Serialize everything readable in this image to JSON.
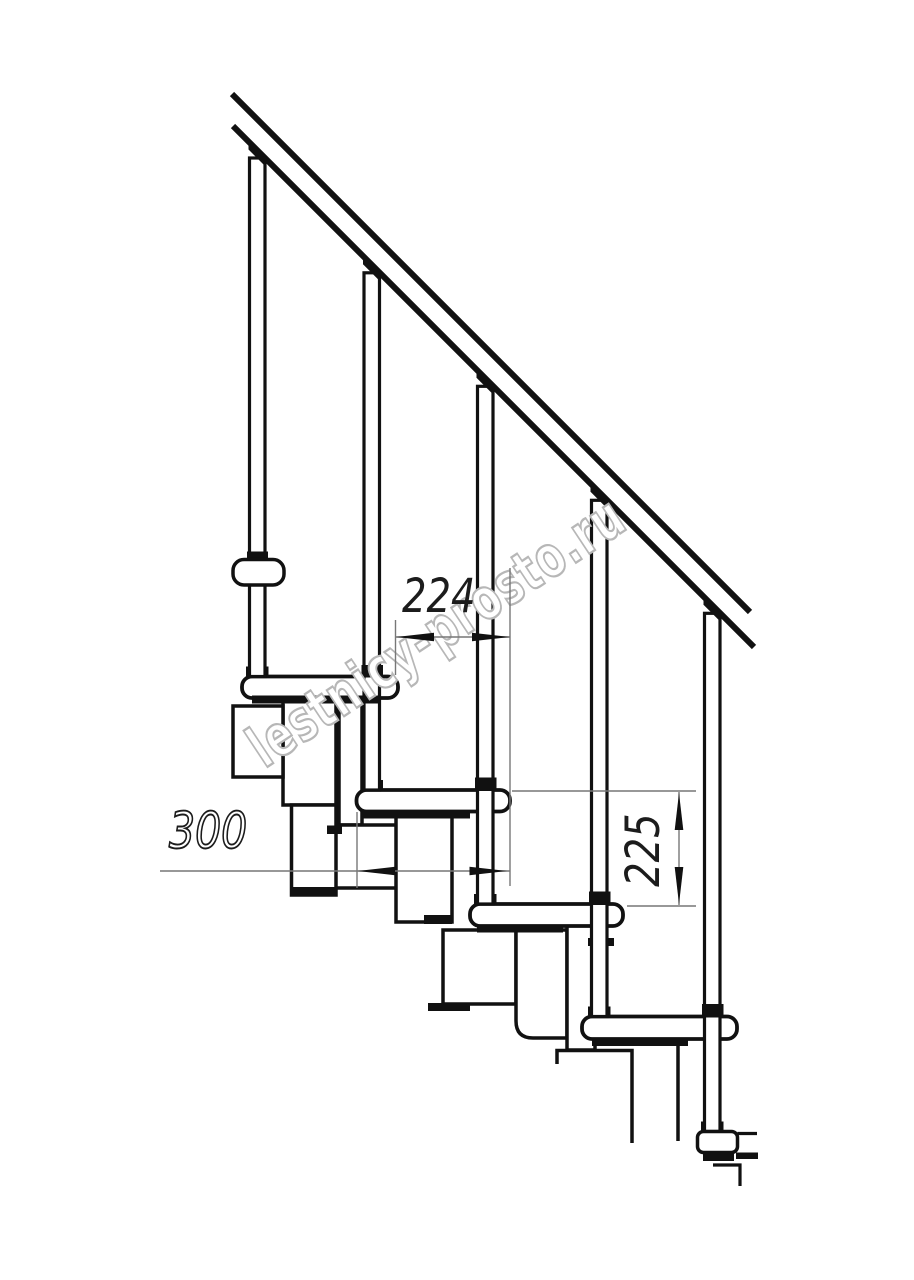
{
  "document": {
    "type": "technical line drawing",
    "subject": "modular staircase side elevation with railing",
    "background_color": "#ffffff",
    "line_color": "#111111",
    "thin_line_color": "#777777",
    "arrow_color": "#111111"
  },
  "dimensions": {
    "going": {
      "value": "224",
      "orientation": "horizontal",
      "style": "solid italic digits"
    },
    "tread_length": {
      "value": "300",
      "orientation": "horizontal",
      "style": "outlined italic digits"
    },
    "rise": {
      "value": "225",
      "orientation": "vertical rotated 90deg",
      "style": "solid italic digits"
    }
  },
  "watermark": {
    "text": "lestnicy-prosto.ru",
    "fill_color": "#ffffff",
    "outline_color": "#b7b7b7",
    "rotation_deg": -33.5
  },
  "parts": {
    "handrail": "sloped double-line handrail",
    "balusters": [
      "baluster-1",
      "baluster-2",
      "baluster-3",
      "baluster-4",
      "baluster-5"
    ],
    "treads": [
      "tread-1",
      "tread-2",
      "tread-3",
      "tread-4"
    ],
    "wall_bracket": "rounded bracket on baluster-1",
    "supports": [
      "module-under-tread-1",
      "module-under-tread-2",
      "module-under-tread-3",
      "module-under-tread-4"
    ],
    "floor_base": "small base plate at bottom right"
  }
}
